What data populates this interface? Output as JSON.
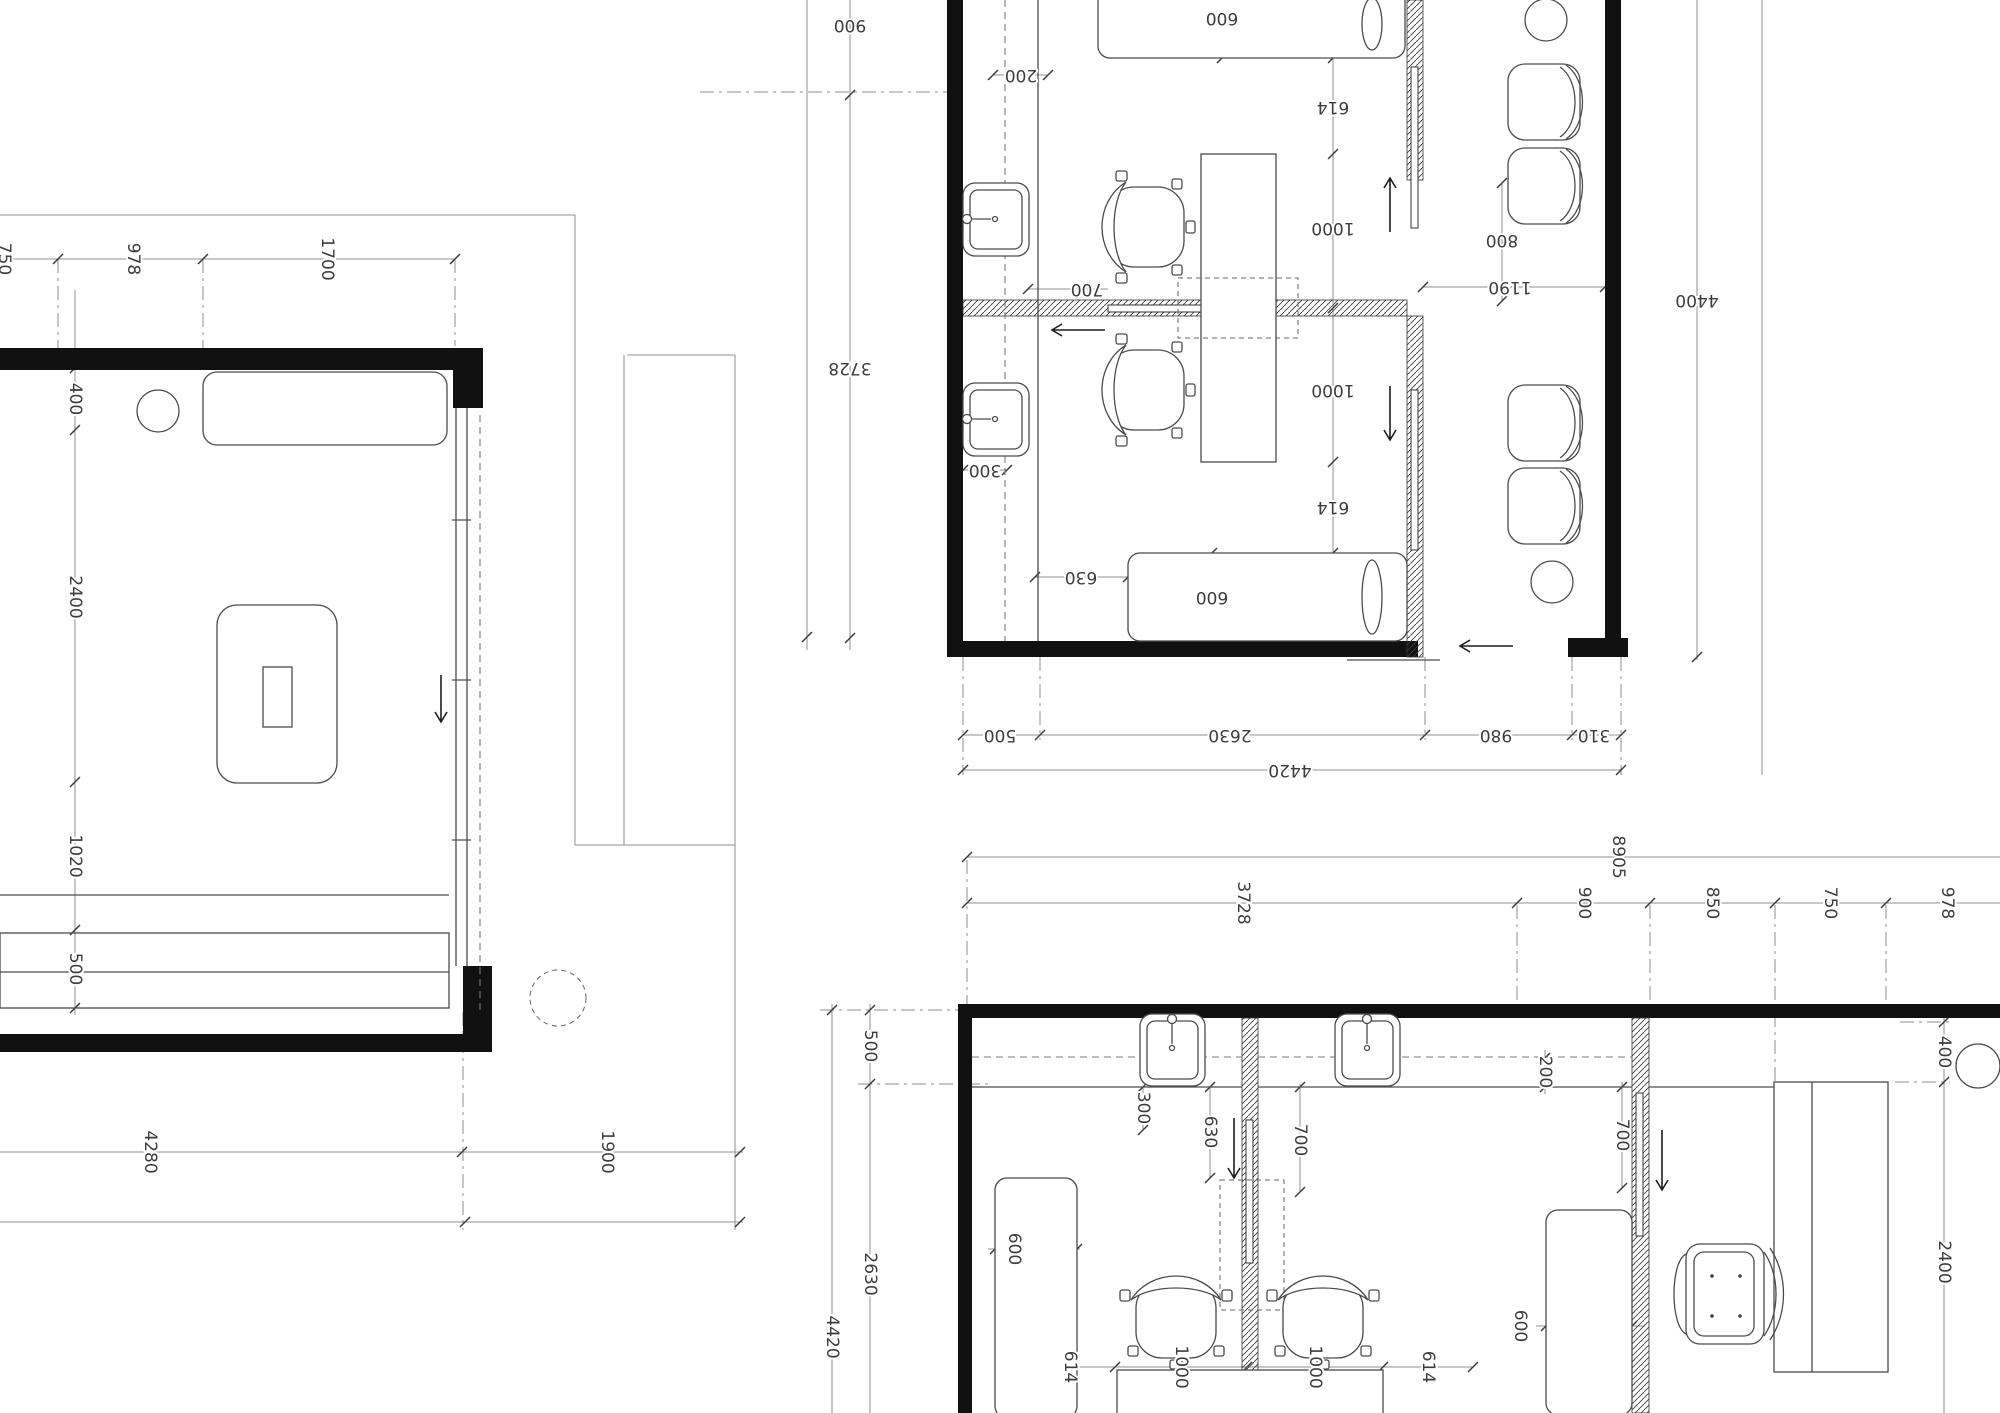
{
  "colors": {
    "background": "#ffffff",
    "wall": "#111111",
    "furniture_line": "#4c4c4c",
    "dimension_line": "#909090",
    "text": "#3c3c3c"
  },
  "plans": [
    {
      "id": "plan-left",
      "labels": [
        {
          "t": "750",
          "x": 4,
          "y": 259,
          "r": 90
        },
        {
          "t": "978",
          "x": 133,
          "y": 259,
          "r": 90
        },
        {
          "t": "1700",
          "x": 327,
          "y": 259,
          "r": 90
        },
        {
          "t": "400",
          "x": 75,
          "y": 399,
          "r": 90
        },
        {
          "t": "2400",
          "x": 75,
          "y": 597,
          "r": 90
        },
        {
          "t": "1020",
          "x": 75,
          "y": 856,
          "r": 90
        },
        {
          "t": "500",
          "x": 75,
          "y": 969,
          "r": 90
        },
        {
          "t": "4280",
          "x": 150,
          "y": 1152,
          "r": 90
        },
        {
          "t": "1900",
          "x": 607,
          "y": 1152,
          "r": 90
        }
      ]
    },
    {
      "id": "plan-top-right",
      "labels": [
        {
          "t": "900",
          "x": 850,
          "y": 25,
          "r": 180
        },
        {
          "t": "3728",
          "x": 850,
          "y": 368,
          "r": 180
        },
        {
          "t": "200",
          "x": 1021,
          "y": 75,
          "r": 180
        },
        {
          "t": "600",
          "x": 1222,
          "y": 18,
          "r": 180
        },
        {
          "t": "614",
          "x": 1333,
          "y": 107,
          "r": 180
        },
        {
          "t": "1000",
          "x": 1333,
          "y": 228,
          "r": 180
        },
        {
          "t": "1000",
          "x": 1333,
          "y": 390,
          "r": 180
        },
        {
          "t": "614",
          "x": 1333,
          "y": 507,
          "r": 180
        },
        {
          "t": "800",
          "x": 1502,
          "y": 240,
          "r": 180
        },
        {
          "t": "700",
          "x": 1087,
          "y": 289,
          "r": 180
        },
        {
          "t": "300",
          "x": 985,
          "y": 470,
          "r": 180
        },
        {
          "t": "630",
          "x": 1081,
          "y": 577,
          "r": 180
        },
        {
          "t": "600",
          "x": 1212,
          "y": 597,
          "r": 180
        },
        {
          "t": "1190",
          "x": 1510,
          "y": 287,
          "r": 180
        },
        {
          "t": "4400",
          "x": 1697,
          "y": 300,
          "r": 180
        },
        {
          "t": "500",
          "x": 1000,
          "y": 735,
          "r": 180
        },
        {
          "t": "2630",
          "x": 1230,
          "y": 735,
          "r": 180
        },
        {
          "t": "980",
          "x": 1496,
          "y": 735,
          "r": 180
        },
        {
          "t": "310",
          "x": 1594,
          "y": 735,
          "r": 180
        },
        {
          "t": "4420",
          "x": 1290,
          "y": 770,
          "r": 180
        }
      ]
    },
    {
      "id": "plan-bottom-right",
      "labels": [
        {
          "t": "8905",
          "x": 1618,
          "y": 857,
          "r": 90
        },
        {
          "t": "3728",
          "x": 1243,
          "y": 903,
          "r": 90
        },
        {
          "t": "900",
          "x": 1584,
          "y": 903,
          "r": 90
        },
        {
          "t": "850",
          "x": 1712,
          "y": 903,
          "r": 90
        },
        {
          "t": "750",
          "x": 1830,
          "y": 903,
          "r": 90
        },
        {
          "t": "978",
          "x": 1947,
          "y": 903,
          "r": 90
        },
        {
          "t": "500",
          "x": 870,
          "y": 1046,
          "r": 90
        },
        {
          "t": "2630",
          "x": 870,
          "y": 1274,
          "r": 90
        },
        {
          "t": "4420",
          "x": 832,
          "y": 1337,
          "r": 90
        },
        {
          "t": "300",
          "x": 1143,
          "y": 1108,
          "r": 90
        },
        {
          "t": "630",
          "x": 1210,
          "y": 1132,
          "r": 90
        },
        {
          "t": "600",
          "x": 1014,
          "y": 1249,
          "r": 90
        },
        {
          "t": "700",
          "x": 1300,
          "y": 1140,
          "r": 90
        },
        {
          "t": "200",
          "x": 1545,
          "y": 1072,
          "r": 90
        },
        {
          "t": "700",
          "x": 1622,
          "y": 1135,
          "r": 90
        },
        {
          "t": "600",
          "x": 1520,
          "y": 1326,
          "r": 90
        },
        {
          "t": "614",
          "x": 1070,
          "y": 1367,
          "r": 90
        },
        {
          "t": "1000",
          "x": 1181,
          "y": 1367,
          "r": 90
        },
        {
          "t": "1000",
          "x": 1315,
          "y": 1367,
          "r": 90
        },
        {
          "t": "614",
          "x": 1428,
          "y": 1367,
          "r": 90
        },
        {
          "t": "400",
          "x": 1944,
          "y": 1052,
          "r": 90
        },
        {
          "t": "2400",
          "x": 1944,
          "y": 1262,
          "r": 90
        }
      ]
    }
  ]
}
